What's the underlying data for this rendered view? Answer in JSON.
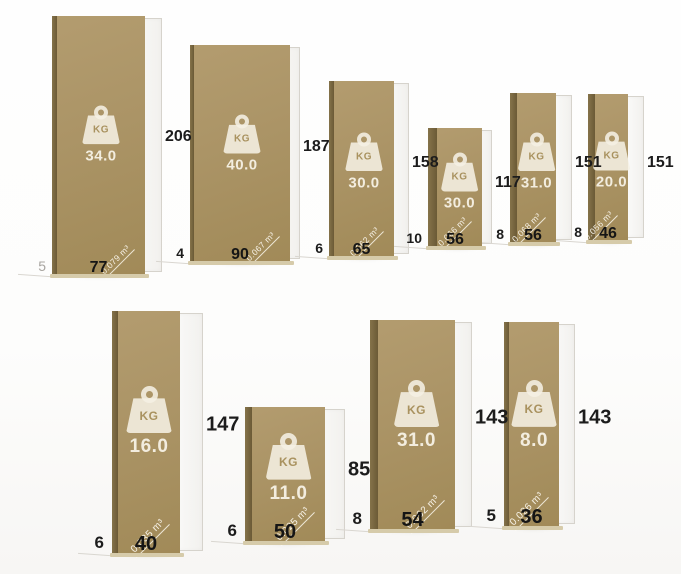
{
  "units": {
    "weight_unit": "KG"
  },
  "colors": {
    "board_face": "#ab9466",
    "board_edge": "#6b5a36",
    "icon_cream": "#f5f0e4",
    "dimension_text": "#1c1c1c",
    "muted_dimension_text": "#a8a5a0",
    "frame_border": "#d6d3cc"
  },
  "boards": [
    {
      "weight": "34.0",
      "height": "206",
      "width": "77",
      "thickness": "5",
      "volume": "0.079 m³"
    },
    {
      "weight": "40.0",
      "height": "187",
      "width": "90",
      "thickness": "4",
      "volume": "0.067 m³"
    },
    {
      "weight": "30.0",
      "height": "158",
      "width": "65",
      "thickness": "6",
      "volume": "0.062 m³"
    },
    {
      "weight": "30.0",
      "height": "117",
      "width": "56",
      "thickness": "10",
      "volume": "0.066 m³"
    },
    {
      "weight": "31.0",
      "height": "151",
      "width": "56",
      "thickness": "8",
      "volume": "0.068 m³"
    },
    {
      "weight": "20.0",
      "height": "151",
      "width": "46",
      "thickness": "8",
      "volume": "0.056 m³"
    },
    {
      "weight": "16.0",
      "height": "147",
      "width": "40",
      "thickness": "6",
      "volume": "0.035 m³"
    },
    {
      "weight": "11.0",
      "height": "85",
      "width": "50",
      "thickness": "6",
      "volume": "0.025 m³"
    },
    {
      "weight": "31.0",
      "height": "143",
      "width": "54",
      "thickness": "8",
      "volume": "0.062 m³"
    },
    {
      "weight": "8.0",
      "height": "143",
      "width": "36",
      "thickness": "5",
      "volume": "0.026 m³"
    }
  ]
}
